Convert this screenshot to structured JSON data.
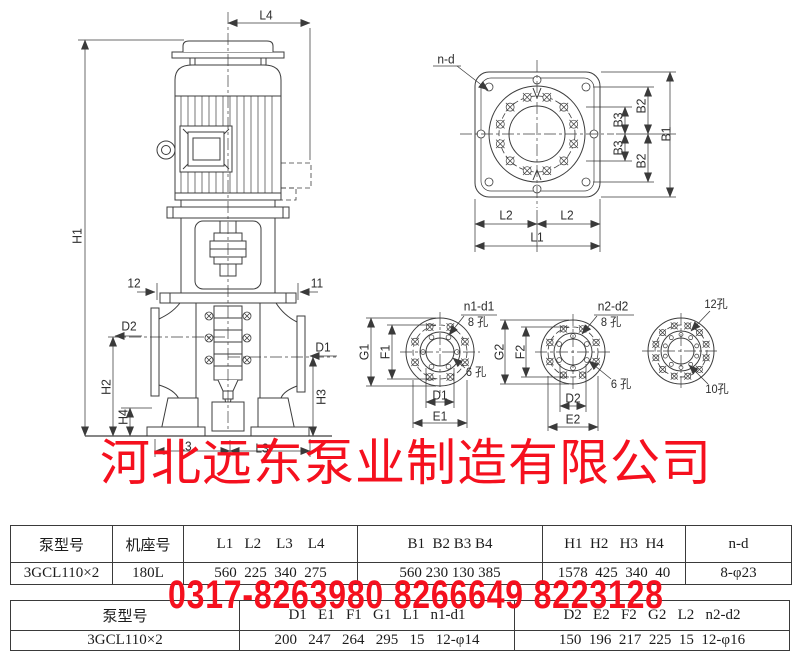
{
  "watermark": {
    "company": "河北远东泵业制造有限公司",
    "phone": "0317-8263980 8266649 8223128",
    "color": "#f5101e"
  },
  "labels": {
    "L4": "L4",
    "H1": "H1",
    "num12": "12",
    "num11": "11",
    "D2": "D2",
    "D1": "D1",
    "H2": "H2",
    "H4": "H4",
    "H3": "H3",
    "L3_left": "L3",
    "L3_right": "L3",
    "n_d": "n-d",
    "B1": "B1",
    "B2_top": "B2",
    "B2_bottom": "B2",
    "B3_top": "B3",
    "B3_bottom": "B3",
    "L2_left": "L2",
    "L2_right": "L2",
    "L1": "L1",
    "n1_d1": "n1-d1",
    "holes8_1": "8 孔",
    "holes6_1": "6 孔",
    "G1": "G1",
    "F1": "F1",
    "D1_flange": "D1",
    "E1": "E1",
    "n2_d2": "n2-d2",
    "holes8_2": "8 孔",
    "holes6_2": "6 孔",
    "G2": "G2",
    "F2": "F2",
    "D2_flange": "D2",
    "E2": "E2",
    "holes12": "12孔",
    "holes10": "10孔"
  },
  "table1": {
    "headers": [
      "泵型号",
      "机座号",
      "L1   L2    L3    L4",
      "B1  B2 B3 B4",
      "H1  H2   H3  H4",
      "n-d"
    ],
    "row": [
      "3GCL110×2",
      "180L",
      "560  225  340  275",
      "560 230 130 385",
      "1578  425  340  40",
      "8-φ23"
    ]
  },
  "table2": {
    "headers": [
      "泵型号",
      "D1   E1   F1   G1   L1   n1-d1",
      "D2   E2   F2   G2   L2   n2-d2"
    ],
    "row": [
      "3GCL110×2",
      "200   247   264   295   15   12-φ14",
      "150  196  217  225  15  12-φ16"
    ]
  }
}
